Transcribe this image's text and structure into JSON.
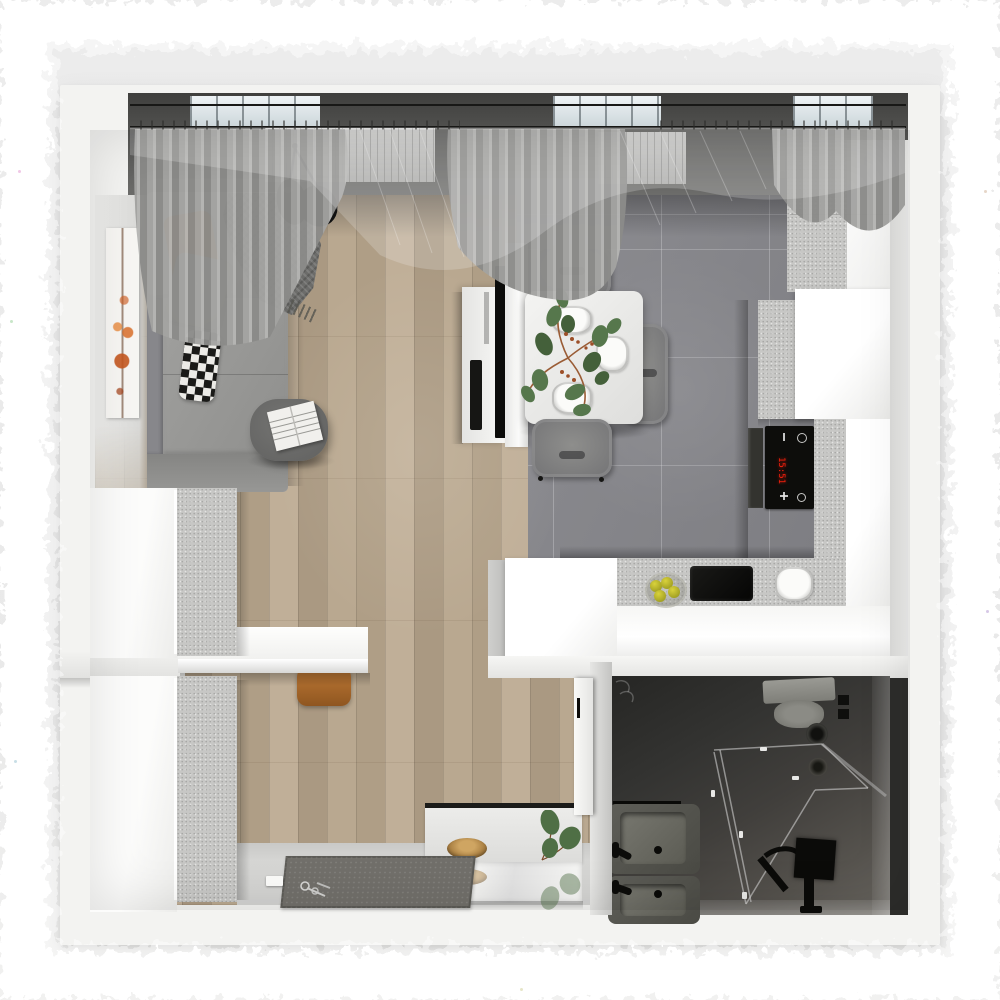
{
  "scene": {
    "title": "Studio apartment — top-down 3D interior render",
    "view": "bird's-eye floor plan visualization",
    "background": "#eaeaea",
    "frame": "rough white painted border"
  },
  "palette": {
    "wall_white": "#f3f3f1",
    "wood_floor": "#b5a48d",
    "tile_floor": "#85858a",
    "cabinet_white": "#fbfbfa",
    "cabinet_speckle": "#c7c7c5",
    "sofa_gray": "#98989a",
    "accent_orange": "#b5702d",
    "curtain_gray": "#9f9f9d",
    "bathroom_dark": "#3a3a37",
    "hob_display_red": "#f01f0c"
  },
  "rooms": [
    {
      "id": "living-room",
      "label": "Living room"
    },
    {
      "id": "kitchen-dining",
      "label": "Kitchen & dining"
    },
    {
      "id": "hall-entry",
      "label": "Hall / entry"
    },
    {
      "id": "bathroom",
      "label": "Bathroom"
    }
  ],
  "living_room": {
    "items": [
      "corner-sofa",
      "cushion-orange",
      "cushion-gray",
      "cushion-diamond",
      "throw-blanket",
      "coffee-table",
      "open-book",
      "pendant-lamp-two-shades",
      "wall-art-orange-tree",
      "curtains-and-sheers",
      "window-radiators"
    ]
  },
  "kitchen_dining": {
    "items": [
      "dining-table",
      "dining-chairs",
      "white-plates",
      "table-plant",
      "tv-partition",
      "wall-tv",
      "media-console",
      "soundbar",
      "tall-cabinets",
      "peninsula-counter",
      "induction-hob",
      "oven",
      "black-sink",
      "fruit-bowl-lemons",
      "plate-on-counter"
    ],
    "chair_count": 3,
    "plate_count": 3,
    "hob_display": {
      "value": "15:51",
      "color": "#f01f0c",
      "buttons": [
        "minus",
        "power",
        "plus",
        "light"
      ]
    }
  },
  "hall_entry": {
    "items": [
      "wardrobe-upper",
      "wardrobe-lower",
      "wall-desk",
      "stool-orange",
      "console-shelf",
      "wood-bowl",
      "wall-mirror",
      "plant-sprig",
      "doormat",
      "keys",
      "door-switch"
    ]
  },
  "bathroom": {
    "items": [
      "toilet",
      "glass-shower-enclosure",
      "black-shower-set",
      "washbasin-upper",
      "washbasin-lower",
      "black-faucets",
      "wall-vent",
      "floor-drain",
      "wall-switches",
      "bathroom-door"
    ]
  }
}
